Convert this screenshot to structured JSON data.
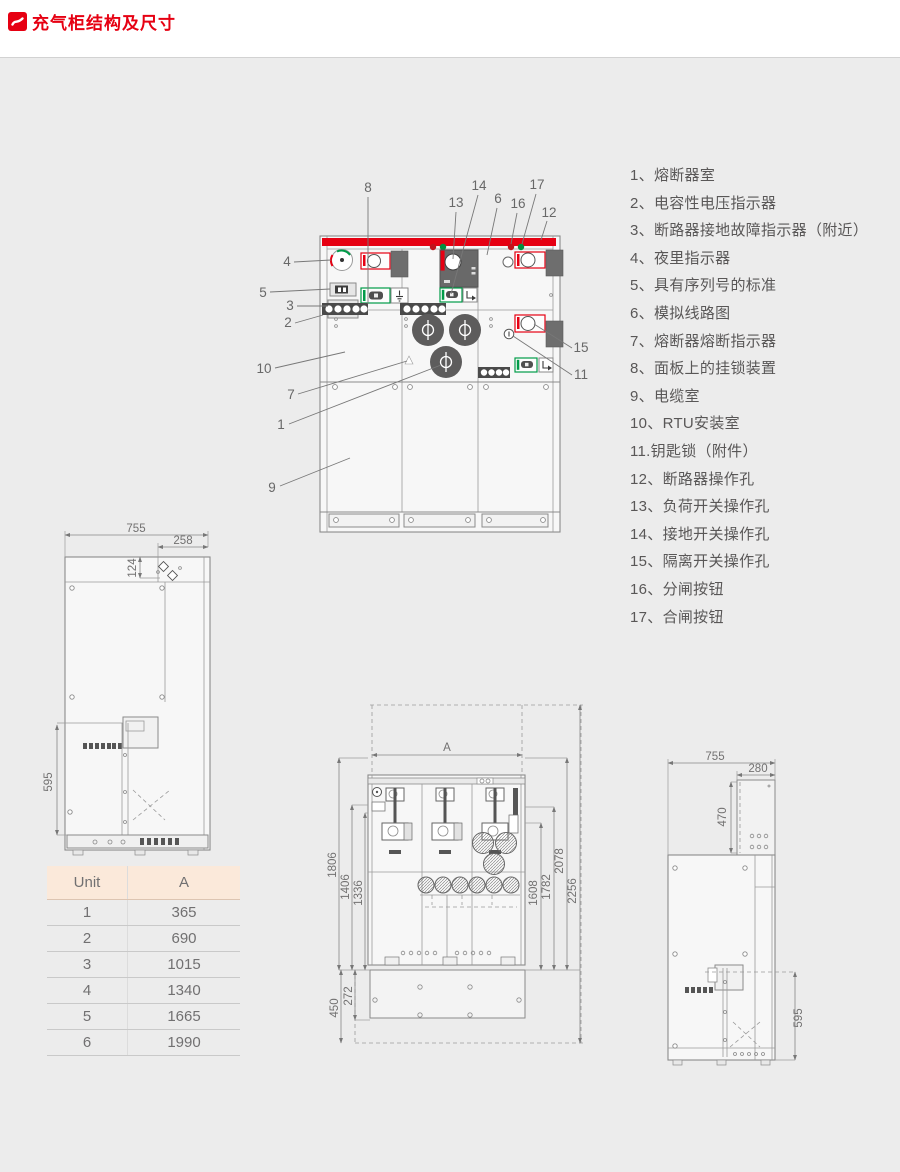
{
  "page": {
    "title": "充气柜结构及尺寸"
  },
  "legend": {
    "items": [
      "1、熔断器室",
      "2、电容性电压指示器",
      "3、断路器接地故障指示器（附近）",
      "4、夜里指示器",
      "5、具有序列号的标准",
      "6、模拟线路图",
      "7、熔断器熔断指示器",
      "8、面板上的挂锁装置",
      "9、电缆室",
      "10、RTU安装室",
      "11.钥匙锁（附件）",
      "12、断路器操作孔",
      "13、负荷开关操作孔",
      "14、接地开关操作孔",
      "15、隔离开关操作孔",
      "16、分闸按钮",
      "17、合闸按钮"
    ]
  },
  "front_view": {
    "callouts": [
      "1",
      "2",
      "3",
      "4",
      "5",
      "6",
      "7",
      "8",
      "9",
      "10",
      "11",
      "12",
      "13",
      "14",
      "15",
      "16",
      "17"
    ]
  },
  "dim_table": {
    "headers": [
      "Unit",
      "A"
    ],
    "rows": [
      [
        "1",
        "365"
      ],
      [
        "2",
        "690"
      ],
      [
        "3",
        "1015"
      ],
      [
        "4",
        "1340"
      ],
      [
        "5",
        "1665"
      ],
      [
        "6",
        "1990"
      ]
    ]
  },
  "side_view_left": {
    "width": "755",
    "top_width": "258",
    "top_height": "124",
    "lower_height": "595"
  },
  "plan_view": {
    "width_label": "A",
    "left": [
      "1806",
      "1406",
      "1336"
    ],
    "bottom_left": [
      "450",
      "272"
    ],
    "right": [
      "1608",
      "1782",
      "2078",
      "2256"
    ]
  },
  "side_view_right": {
    "width": "755",
    "top_width": "280",
    "top_height": "470",
    "lower_height": "595"
  },
  "colors": {
    "accent": "#e60012",
    "green": "#009b48"
  }
}
